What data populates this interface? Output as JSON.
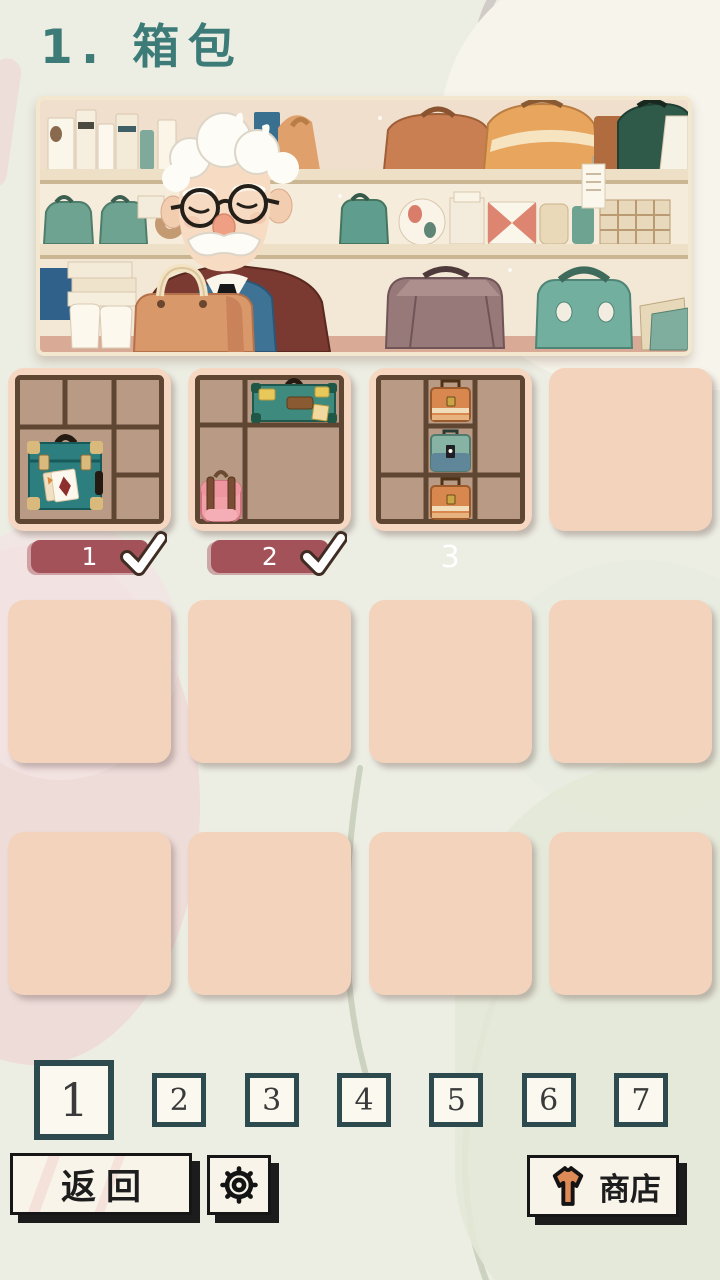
{
  "title": "1. 箱包",
  "levels": [
    {
      "label": "1",
      "state": "completed"
    },
    {
      "label": "2",
      "state": "completed"
    },
    {
      "label": "3",
      "state": "available"
    },
    {
      "label": "",
      "state": "empty"
    },
    {
      "label": "",
      "state": "empty"
    },
    {
      "label": "",
      "state": "empty"
    },
    {
      "label": "",
      "state": "empty"
    },
    {
      "label": "",
      "state": "empty"
    },
    {
      "label": "",
      "state": "empty"
    },
    {
      "label": "",
      "state": "empty"
    },
    {
      "label": "",
      "state": "empty"
    },
    {
      "label": "",
      "state": "empty"
    }
  ],
  "pager": {
    "pages": [
      "1",
      "2",
      "3",
      "4",
      "5",
      "6",
      "7"
    ],
    "selected": "1"
  },
  "footer": {
    "back_label": "返回",
    "shop_label": "商店"
  },
  "icons": {
    "settings": "gear-icon",
    "shop": "tshirt-icon",
    "completed": "checkmark-icon"
  },
  "colors": {
    "title_teal": "#3c7b77",
    "badge_red": "#a4525a",
    "card_empty": "#f4d3bd",
    "grid_bg": "#b89a85",
    "grid_line": "#5f4633",
    "pager_border": "#2d4a4f",
    "shirt_orange": "#dd8a56"
  }
}
